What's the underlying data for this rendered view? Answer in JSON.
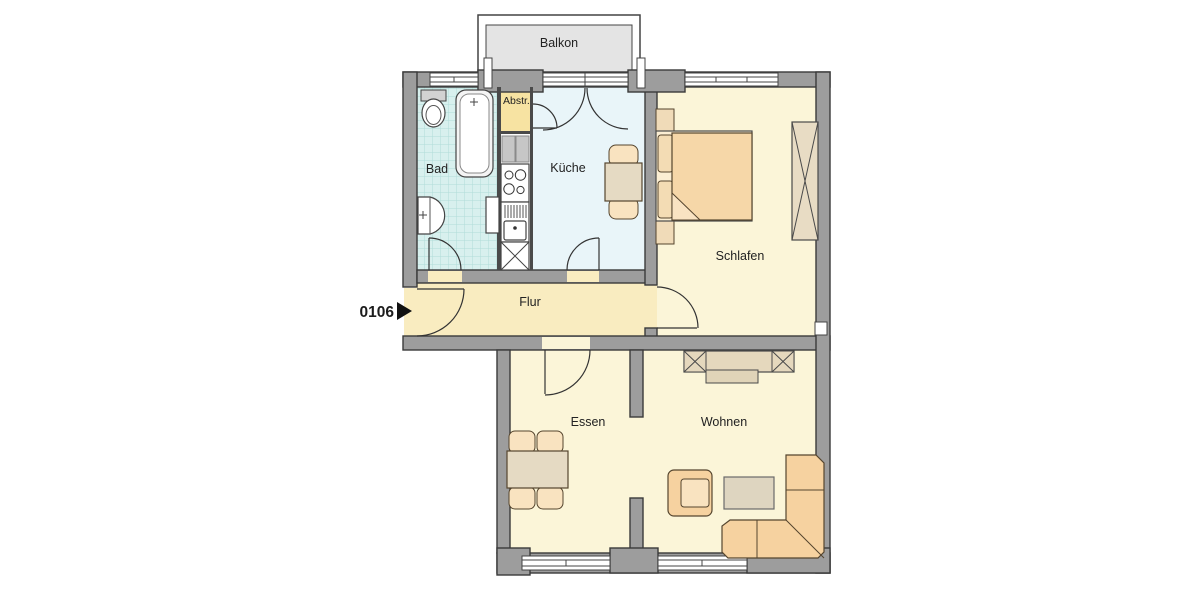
{
  "floorplan": {
    "unit_number": "0106",
    "rooms": {
      "balkon": {
        "label": "Balkon"
      },
      "bad": {
        "label": "Bad"
      },
      "abstellraum": {
        "label": "Abstr."
      },
      "kueche": {
        "label": "Küche"
      },
      "schlafen": {
        "label": "Schlafen"
      },
      "flur": {
        "label": "Flur"
      },
      "essen": {
        "label": "Essen"
      },
      "wohnen": {
        "label": "Wohnen"
      }
    },
    "colors": {
      "wall_fill": "#9d9d9d",
      "wall_outline": "#3a3a3a",
      "bathroom_floor": "#d8f0ee",
      "bathroom_tile_line": "#b0dcd8",
      "kitchen_floor": "#e9f5f9",
      "hall_floor": "#f9ecc0",
      "storage_floor": "#f7e3a2",
      "living_floor": "#fbf5d8",
      "balcony_floor": "#e4e4e4",
      "furniture_wood": "#e5dac3",
      "upholstery": "#f6d2a0",
      "entry_marker": "#111111"
    }
  }
}
